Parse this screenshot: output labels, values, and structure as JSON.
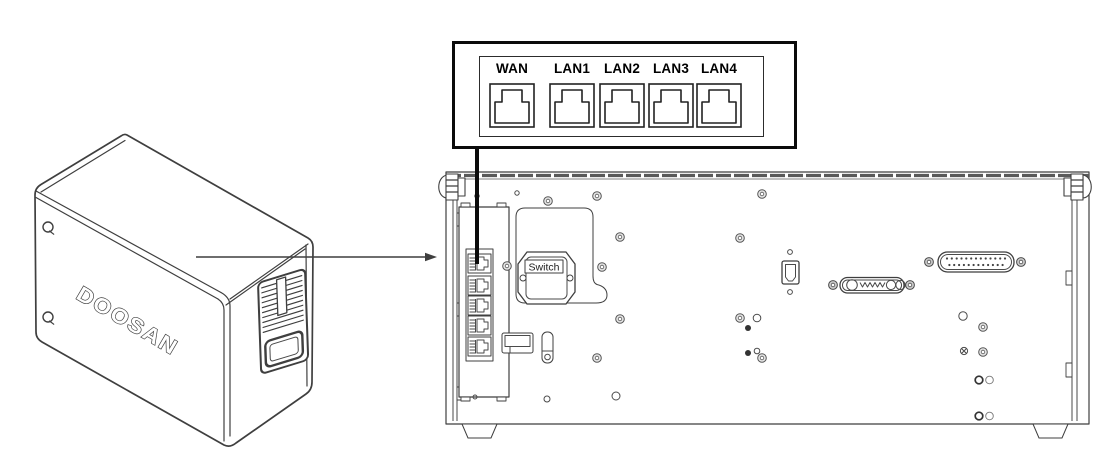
{
  "callout": {
    "ports": [
      {
        "label": "WAN"
      },
      {
        "label": "LAN1"
      },
      {
        "label": "LAN2"
      },
      {
        "label": "LAN3"
      },
      {
        "label": "LAN4"
      }
    ]
  },
  "device": {
    "brand_label": "DOOSAN"
  },
  "panel": {
    "switch_label": "Switch"
  },
  "colors": {
    "line": "#3f3f3f",
    "panel_line": "#4a4a4a",
    "text": "#000000",
    "background": "#ffffff"
  }
}
